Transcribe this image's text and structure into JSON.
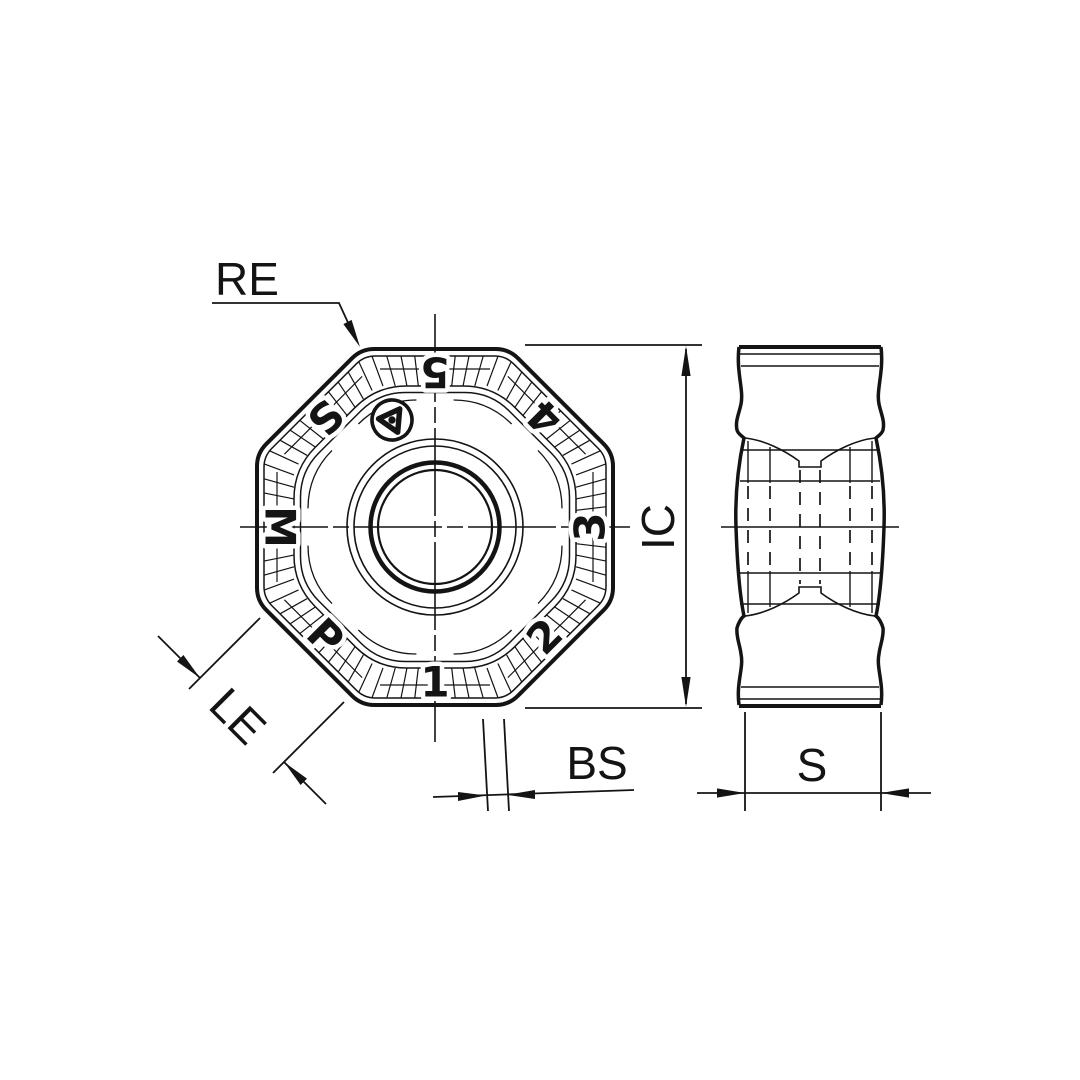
{
  "drawing": {
    "type": "technical-insert-drawing",
    "views": {
      "front": "insert-face-view",
      "side": "insert-thickness-view"
    }
  },
  "labels": {
    "re": "RE",
    "ic": "IC",
    "le": "LE",
    "bs": "BS",
    "s": "S"
  },
  "front_view": {
    "marks": [
      {
        "face": "top",
        "text": "5"
      },
      {
        "face": "top-right",
        "text": "4"
      },
      {
        "face": "right",
        "text": "3"
      },
      {
        "face": "bottom-right",
        "text": "2"
      },
      {
        "face": "bottom",
        "text": "1"
      },
      {
        "face": "bottom-left",
        "text": "P"
      },
      {
        "face": "left",
        "text": "M"
      },
      {
        "face": "top-left",
        "text": "S"
      }
    ],
    "logo_icon": "trefoil-spinner-logo"
  },
  "colors": {
    "line": "#141414",
    "background": "#ffffff"
  }
}
